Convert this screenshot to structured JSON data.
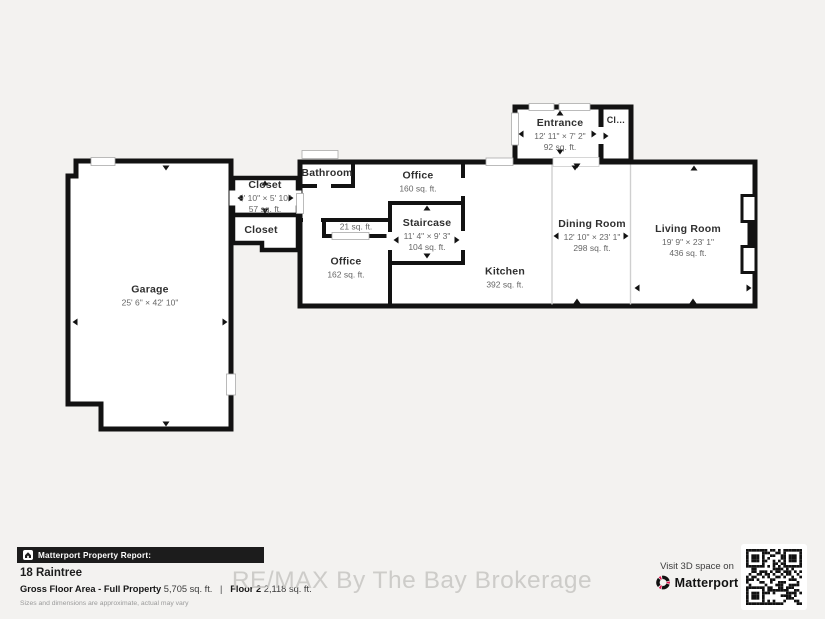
{
  "watermark": "RE/MAX By The Bay Brokerage",
  "rooms": {
    "garage": {
      "name": "Garage",
      "dims": "25' 6\" × 42' 10\""
    },
    "closet_upper": {
      "name": "Closet",
      "dims": "9' 10\" × 5' 10\"",
      "area": "57 sq. ft."
    },
    "closet_lower": {
      "name": "Closet"
    },
    "bathroom": {
      "name": "Bathroom"
    },
    "office_upper": {
      "name": "Office",
      "area": "160 sq. ft."
    },
    "staircase": {
      "name": "Staircase",
      "dims": "11' 4\" × 9' 3\"",
      "area": "104 sq. ft."
    },
    "closet_small": {
      "area": "21 sq. ft."
    },
    "office_lower": {
      "name": "Office",
      "area": "162 sq. ft."
    },
    "entrance": {
      "name": "Entrance",
      "dims": "12' 11\" × 7' 2\"",
      "area": "92 sq. ft."
    },
    "closet_entry": {
      "name": "Cl…"
    },
    "kitchen": {
      "name": "Kitchen",
      "area": "392 sq. ft."
    },
    "dining": {
      "name": "Dining Room",
      "dims": "12' 10\" × 23' 1\"",
      "area": "298 sq. ft."
    },
    "living": {
      "name": "Living Room",
      "dims": "19' 9\" × 23' 1\"",
      "area": "436 sq. ft."
    }
  },
  "footer": {
    "report_label": "Matterport Property Report:",
    "property_name": "18 Raintree",
    "gross_label": "Gross Floor Area - Full Property",
    "gross_value": "5,705 sq. ft.",
    "floor_label": "Floor 2",
    "floor_value": "2,118 sq. ft.",
    "disclaimer": "Sizes and dimensions are approximate, actual may vary"
  },
  "visit3d": {
    "line": "Visit 3D space on",
    "brand": "Matterport"
  },
  "colors": {
    "background": "#f3f2f0",
    "wall": "#121212",
    "room_fill": "#ffffff",
    "brand_red": "#e0144d",
    "report_bar": "#1c1c1c"
  }
}
